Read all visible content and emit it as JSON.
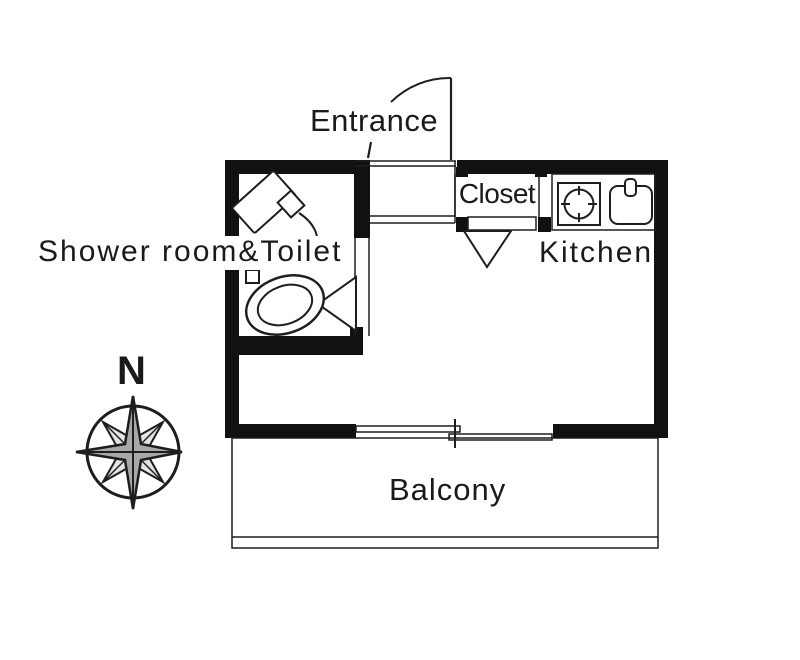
{
  "title": "Studio apartment floor plan",
  "labels": {
    "entrance": "Entrance",
    "closet": "Closet",
    "kitchen": "Kitchen",
    "shower_toilet": "Shower room&Toilet",
    "balcony": "Balcony",
    "compass_north": "N"
  },
  "icons": {
    "compass": "compass-rose-icon",
    "stove": "stove-burner-icon",
    "sink": "kitchen-sink-icon",
    "shower": "shower-head-icon",
    "toilet": "toilet-icon",
    "entrance_door": "door-swing-arc-icon",
    "room_doors": "door-triangle-icon",
    "window": "sliding-door-icon"
  },
  "colors": {
    "wall": "#111111",
    "line": "#1e1e1e",
    "text": "#1a1a1a",
    "background": "#ffffff",
    "compass_main_fill": "#a8a8a8",
    "compass_diag_fill": "#e3e3e3"
  }
}
